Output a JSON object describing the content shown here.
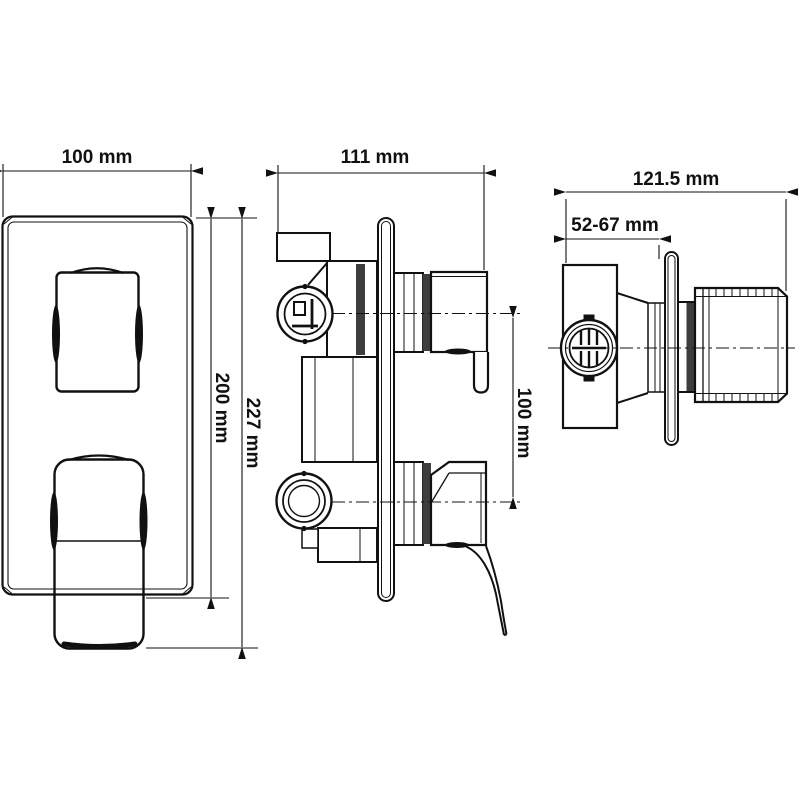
{
  "drawing": {
    "type": "technical-dimension-drawing",
    "subject": "concealed shower mixer valve, three orthographic views"
  },
  "labels": {
    "front_width": "100 mm",
    "front_plate_height": "200 mm",
    "front_total_height": "227 mm",
    "side_width": "111 mm",
    "side_port_spacing": "100 mm",
    "profile_width": "121.5 mm",
    "profile_wall_depth": "52-67 mm"
  },
  "colors": {
    "line": "#111111",
    "shade_dark": "#3d3d3d",
    "background": "#ffffff"
  }
}
